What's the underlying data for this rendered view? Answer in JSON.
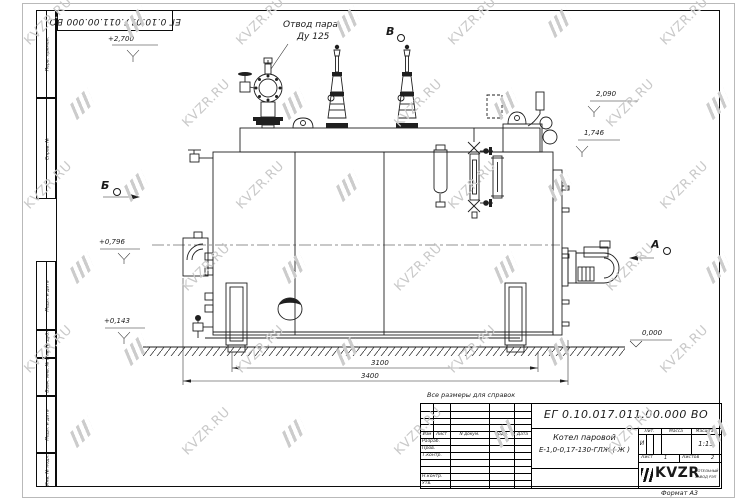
{
  "sheet": {
    "watermark_text": "KVZR.RU",
    "format_label": "Формат А3",
    "note": "Все размеры для справок",
    "doc_number": "ЕГ 0.10.017.011.00.000  ВО"
  },
  "frame_left": {
    "labels": [
      "Перв. примен.",
      "Справ. №",
      "Подп. и дата",
      "Инв. № дубл.",
      "Взам. инв. №",
      "Подп. и дата",
      "Инв. № подл."
    ]
  },
  "drawing": {
    "callout_line1": "Отвод пара",
    "callout_line2": "Ду 125",
    "view_b": "Б",
    "view_v": "В",
    "view_a": "А",
    "elev_2700": "+2,700",
    "elev_2090": "2,090",
    "elev_1746": "1,746",
    "elev_0796": "+0,796",
    "elev_0143": "+0,143",
    "elev_0000": "0,000",
    "dim_3100": "3100",
    "dim_3400": "3400"
  },
  "title_block": {
    "doc_number": "ЕГ 0.10.017.011.00.000  ВО",
    "name_line1": "Котел паровой",
    "name_line2": "Е-1,0-0,17-130-ГЛЖ ( Ж )",
    "header_izm": "Изм",
    "header_list": "Лист",
    "header_ndokum": "N докум.",
    "header_podp": "Подп.",
    "header_data": "Дата",
    "row_razrab": "Разраб.",
    "row_prov": "Пров.",
    "row_tkontr": "Т.контр.",
    "row_nkontr": "Н.контр.",
    "row_utv": "Утв.",
    "lit_label": "Лит.",
    "mass_label": "Масса",
    "scale_label": "Масштаб",
    "lit_value": "И",
    "scale_value": "1:15",
    "list_label": "Лист",
    "list_value": "1",
    "listov_label": "Листов",
    "listov_value": "2",
    "logo_text": "KVZR",
    "logo_sub1": "КОТЕЛЬНЫЙ",
    "logo_sub2": "ЗАВОД РЭП"
  }
}
